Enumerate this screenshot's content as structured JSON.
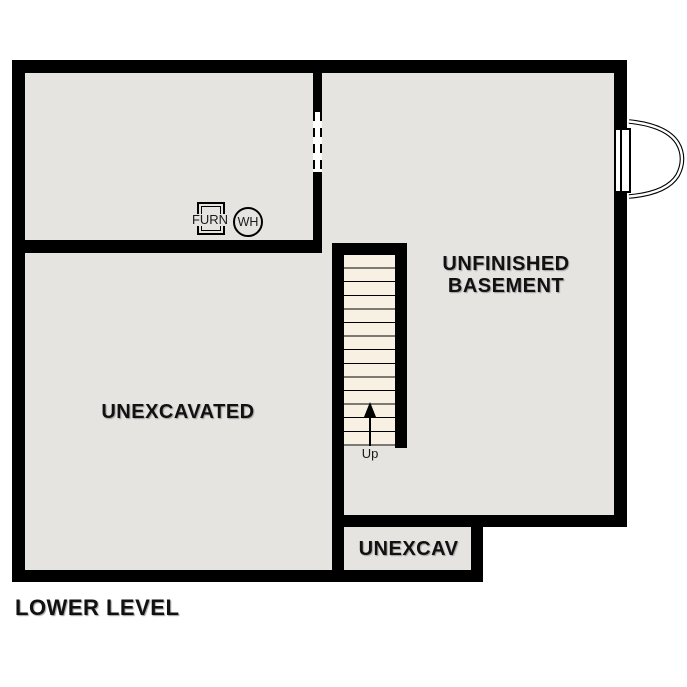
{
  "plan": {
    "title": "LOWER LEVEL",
    "rooms": {
      "unfinished_basement": {
        "line1": "UNFINISHED",
        "line2": "BASEMENT"
      },
      "unexcavated": {
        "label": "UNEXCAVATED"
      },
      "unexcav_small": {
        "label": "UNEXCAV"
      }
    },
    "stairs": {
      "up_label": "Up"
    },
    "equipment": {
      "furnace": "FURN",
      "water_heater": "WH"
    }
  },
  "colors": {
    "wall": "#000000",
    "room_fill": "#e6e4e1",
    "stair_tread_fill": "#f8f1e3",
    "door_opening_fill": "#ffffff",
    "window_frame_fill": "#ffffff",
    "text": "#111111",
    "background": "#ffffff"
  }
}
